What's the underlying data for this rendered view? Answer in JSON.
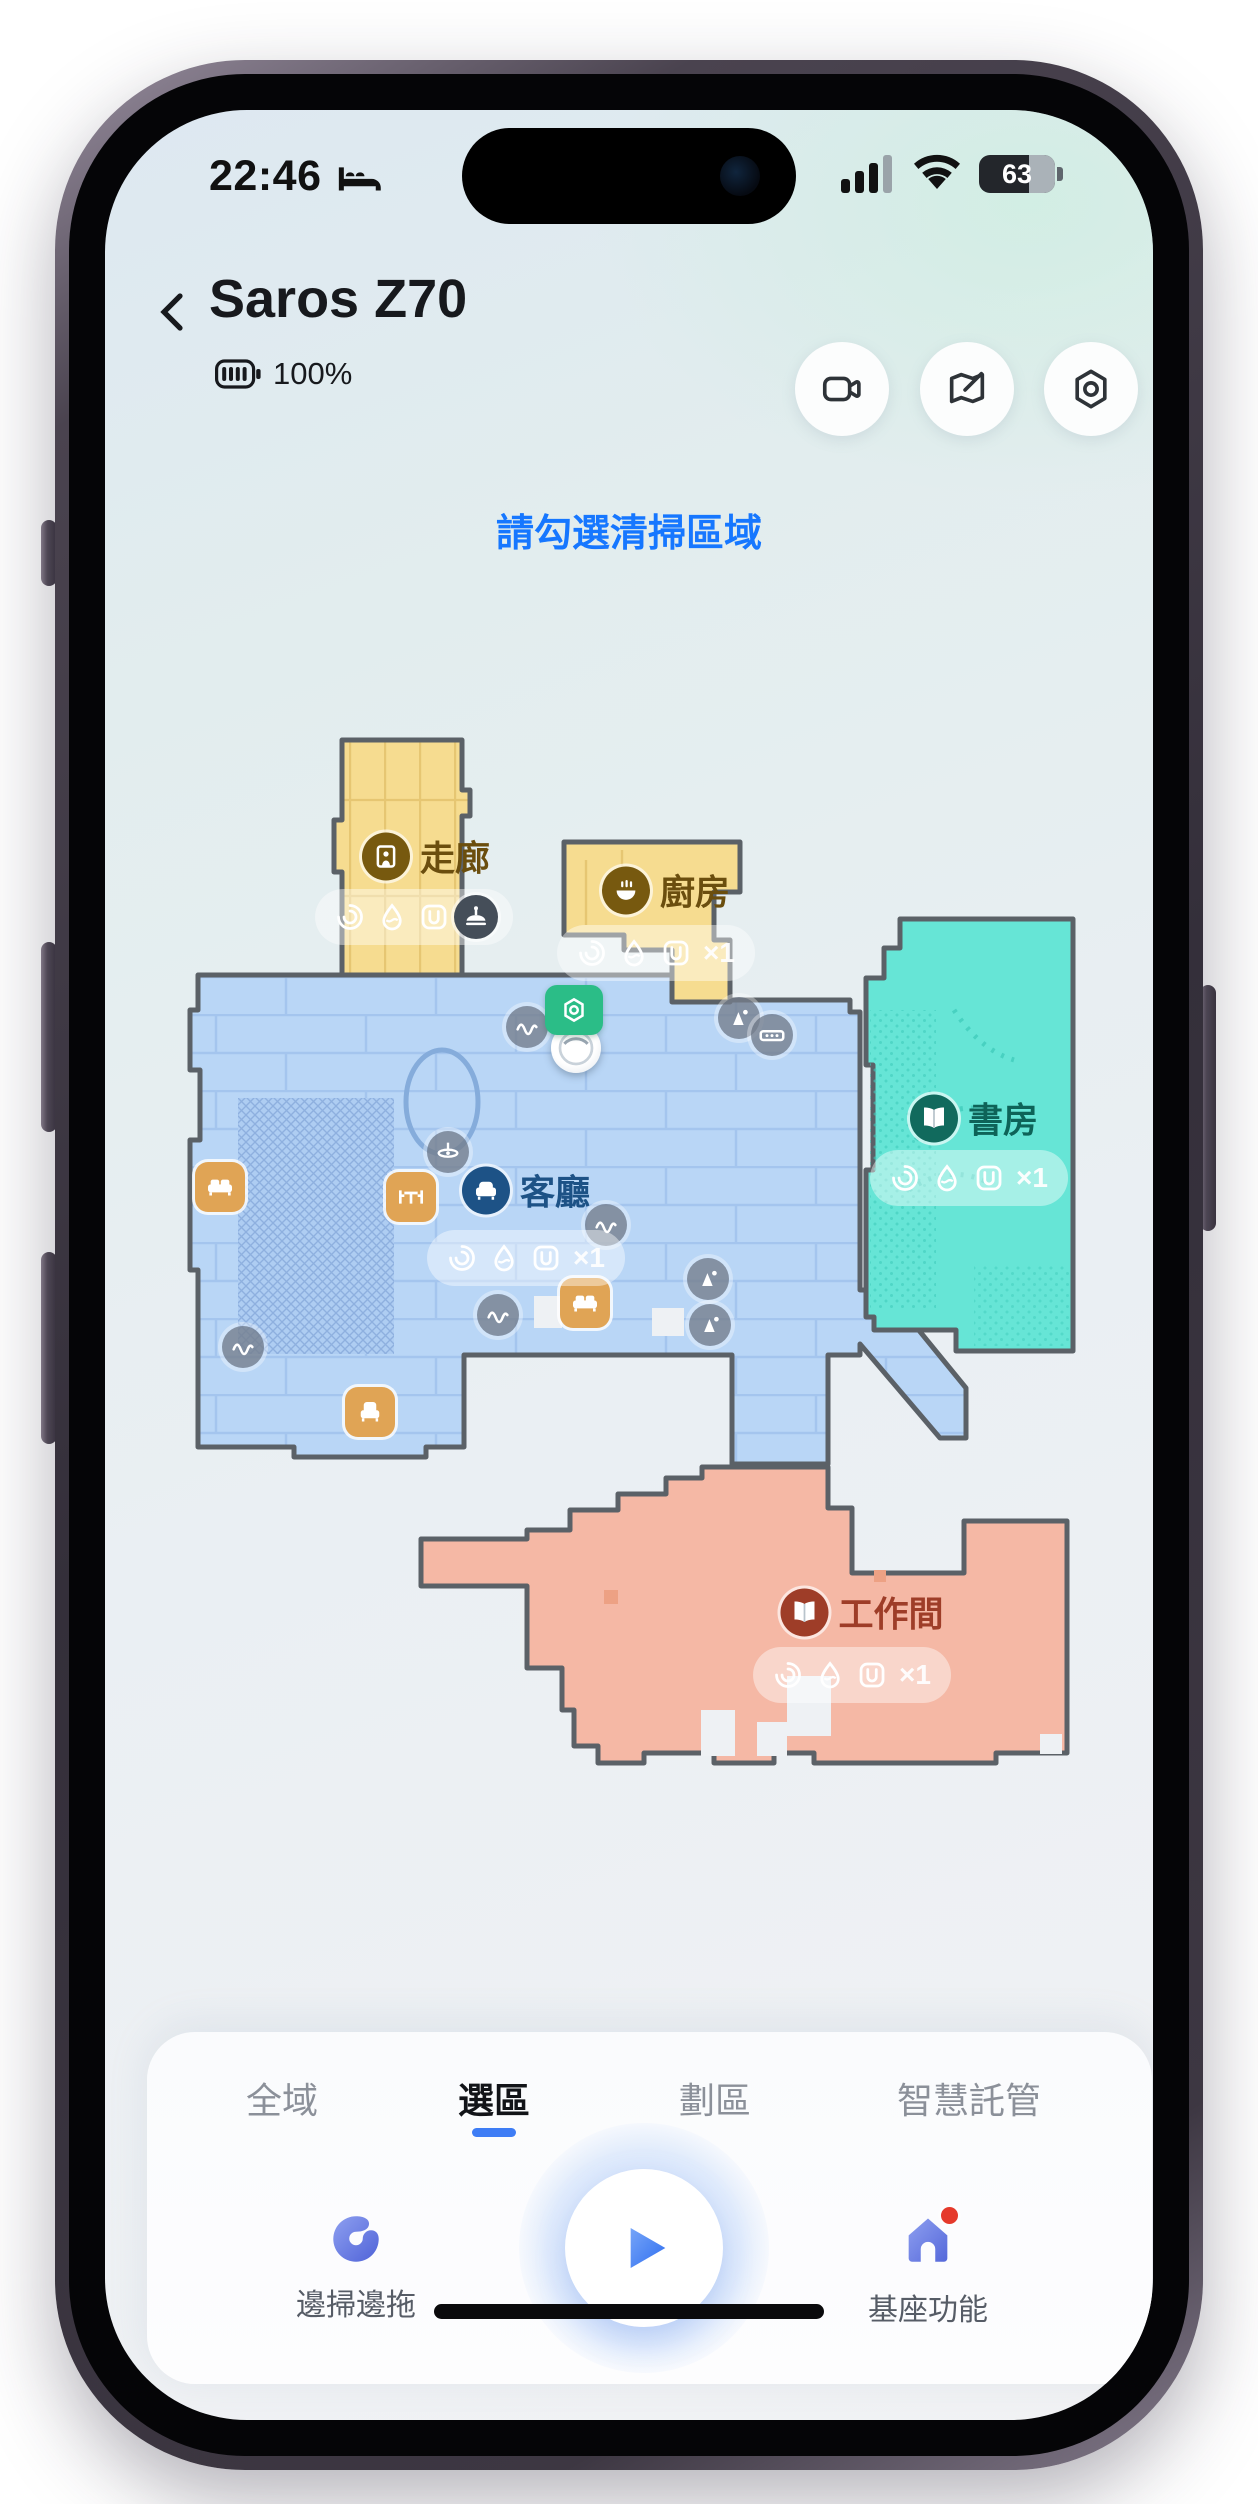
{
  "status_bar": {
    "time": "22:46",
    "battery_percent": "63"
  },
  "header": {
    "title": "Saros Z70",
    "robot_battery": "100%"
  },
  "header_buttons": [
    {
      "name": "camera-view-button"
    },
    {
      "name": "map-edit-button"
    },
    {
      "name": "settings-button"
    }
  ],
  "prompt": {
    "text": "請勾選清掃區域",
    "color": "#1677ff"
  },
  "map": {
    "rooms": [
      {
        "id": "corridor",
        "name": "走廊",
        "fill": "#f6dc90",
        "label_color": "#6b4e0e",
        "circle_color": "#77590f",
        "glyph": "door",
        "clean_count": "×1",
        "label_pos": [
          252,
          146
        ],
        "pill_pos": [
          240,
          207
        ]
      },
      {
        "id": "kitchen",
        "name": "廚房",
        "fill": "#f6dc90",
        "label_color": "#6b4e0e",
        "circle_color": "#77590f",
        "glyph": "bowl",
        "clean_count": "×1",
        "label_pos": [
          492,
          180
        ],
        "pill_pos": [
          482,
          243
        ]
      },
      {
        "id": "living",
        "name": "客廳",
        "fill": "#b9d6f6",
        "label_color": "#1d5286",
        "circle_color": "#1d5286",
        "glyph": "sofa",
        "clean_count": "×1",
        "label_pos": [
          352,
          480
        ],
        "pill_pos": [
          352,
          548
        ]
      },
      {
        "id": "study",
        "name": "書房",
        "fill": "#66e5d6",
        "label_color": "#0e6358",
        "circle_color": "#116a5d",
        "glyph": "book",
        "clean_count": "×1",
        "label_pos": [
          800,
          408
        ],
        "pill_pos": [
          795,
          468
        ]
      },
      {
        "id": "workroom",
        "name": "工作間",
        "fill": "#f5b8a5",
        "label_color": "#9e3d28",
        "circle_color": "#9e3d28",
        "glyph": "book",
        "clean_count": "×1",
        "label_pos": [
          688,
          902
        ],
        "pill_pos": [
          678,
          965
        ]
      }
    ],
    "icons": [
      {
        "type": "dock-icon",
        "x": 400,
        "y": 300
      },
      {
        "type": "robot-icon",
        "x": 402,
        "y": 338
      },
      {
        "type": "cable-icon",
        "x": 353,
        "y": 317
      },
      {
        "type": "cable-icon",
        "x": 432,
        "y": 515
      },
      {
        "type": "cable-icon",
        "x": 324,
        "y": 605
      },
      {
        "type": "cable-icon",
        "x": 69,
        "y": 637
      },
      {
        "type": "cone-icon",
        "x": 565,
        "y": 308
      },
      {
        "type": "cone-icon",
        "x": 534,
        "y": 569
      },
      {
        "type": "cone-icon",
        "x": 536,
        "y": 615
      },
      {
        "type": "power-strip-icon",
        "x": 598,
        "y": 325
      },
      {
        "type": "ceiling-fan-icon",
        "x": 274,
        "y": 442
      },
      {
        "type": "sofa-icon",
        "x": 46,
        "y": 477
      },
      {
        "type": "table-icon",
        "x": 237,
        "y": 487
      },
      {
        "type": "sofa-icon",
        "x": 411,
        "y": 593
      },
      {
        "type": "armchair-icon",
        "x": 196,
        "y": 702
      },
      {
        "type": "robot-obstacle-icon",
        "x": 302,
        "y": 207
      }
    ]
  },
  "tabs": [
    {
      "label": "全域",
      "active": false
    },
    {
      "label": "選區",
      "active": true
    },
    {
      "label": "劃區",
      "active": false
    },
    {
      "label": "智慧託管",
      "active": false
    }
  ],
  "actions": {
    "left_label": "邊掃邊拖",
    "right_label": "基座功能"
  },
  "colors": {
    "accent_blue": "#1677ff",
    "tab_underline": "#3e7df5",
    "wall": "#5b6167",
    "dock_green": "#2bbd87",
    "notification_red": "#e5392b"
  }
}
